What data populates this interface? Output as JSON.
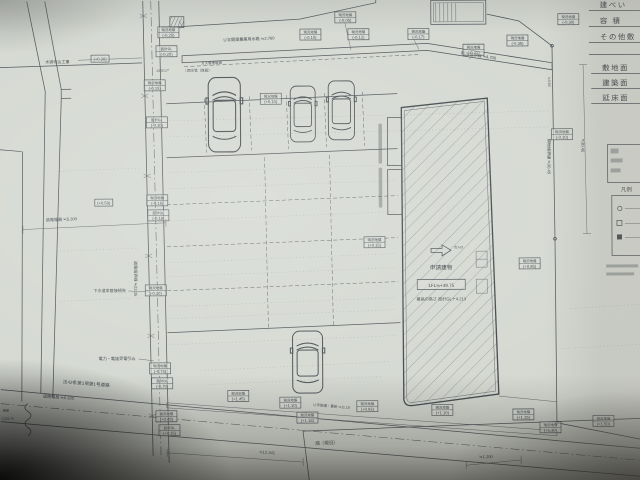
{
  "margin_table": {
    "rows": [
      "建ぺい",
      "容 積",
      "その他敷",
      "敷地面",
      "建築面",
      "延床面"
    ]
  },
  "legend": {
    "title": "凡例"
  },
  "building": {
    "name": "申請建物",
    "floor_level": "1FL≒+49.75",
    "max_height": "最高の高さ 設計GL＋4.213",
    "arrow_note": "出入口"
  },
  "roads": {
    "front_name": "法42条第1項第1号道路",
    "front_width": "道路幅員 ≒6.320",
    "side_width": "道路幅員 ≒5.300"
  },
  "channels": {
    "top": "Ｕ字開渠農業用水路 ≒2.760",
    "right": "隣地境界線 ≒4.700",
    "bottom": "Ｕ字側溝・蓋掛 ≒11.18"
  },
  "utilities": {
    "water": "水道引込工事",
    "sewer": "下水道本管接続先",
    "power": "電力・電話受電引込",
    "gas": "ガス管埋設管",
    "rain": "□雨水管（既設）",
    "angle": "13°0′17″"
  },
  "boundaries": {
    "right": "隣地境界線 ≒30.45",
    "left": "道路境界線 ≒23.35",
    "right_top_dim": "≒4.50",
    "right_dim": "≒30.45"
  },
  "dims": {
    "bottom_left": "≒12.341",
    "bottom_right": "≒1.200"
  },
  "site": {
    "field": "畑（現況）",
    "wall": "擁壁",
    "wall_level": "▽101.70"
  },
  "spot_single": {
    "a": "(+0.30)",
    "b": "(+0.50)"
  },
  "spots": [
    {
      "t": "現況地盤",
      "v": "(-0.05)"
    },
    {
      "t": "現況地盤",
      "v": "(-0.10)"
    },
    {
      "t": "現況地盤",
      "v": "(-0.12)"
    },
    {
      "t": "現況地盤",
      "v": "(-0.17)"
    },
    {
      "t": "現況地盤",
      "v": "(-0.21)"
    },
    {
      "t": "現況地盤",
      "v": "(-0.30)"
    },
    {
      "t": "現況地盤",
      "v": "(-0.35)"
    },
    {
      "t": "現況地盤",
      "v": "(-0.25)"
    },
    {
      "t": "設計GL",
      "v": "(-0.20)"
    },
    {
      "t": "現況地盤",
      "v": "(-0.15)"
    },
    {
      "t": "設計GL",
      "v": "(-0.10)"
    },
    {
      "t": "現況地盤",
      "v": "(-0.15)"
    },
    {
      "t": "設計GL",
      "v": "(-0.18)"
    },
    {
      "t": "現況地盤",
      "v": "(-0.20)"
    },
    {
      "t": "現況地盤",
      "v": "(-0.75)"
    },
    {
      "t": "設計GL",
      "v": "(-0.70)"
    },
    {
      "t": "現況地盤",
      "v": "(+0.45)"
    },
    {
      "t": "設計GL",
      "v": "(+0.15)"
    },
    {
      "t": "現況地盤",
      "v": "(+0.10)"
    },
    {
      "t": "現況地盤",
      "v": "(+0.15)"
    },
    {
      "t": "現況地盤",
      "v": "(-0.10)"
    },
    {
      "t": "現況地盤",
      "v": "(+1.45)"
    },
    {
      "t": "現況地盤",
      "v": "(+1.10)"
    },
    {
      "t": "現況地盤",
      "v": "(+1.18)"
    },
    {
      "t": "現況地盤",
      "v": "(+0.93)"
    },
    {
      "t": "現況地盤",
      "v": "(+1.10)"
    },
    {
      "t": "現況地盤",
      "v": "(+1.15)"
    },
    {
      "t": "現況地盤",
      "v": "(+1.30)"
    },
    {
      "t": "現況地盤",
      "v": "(+1.50)"
    },
    {
      "t": "現況地盤",
      "v": "(+0.85)"
    }
  ]
}
